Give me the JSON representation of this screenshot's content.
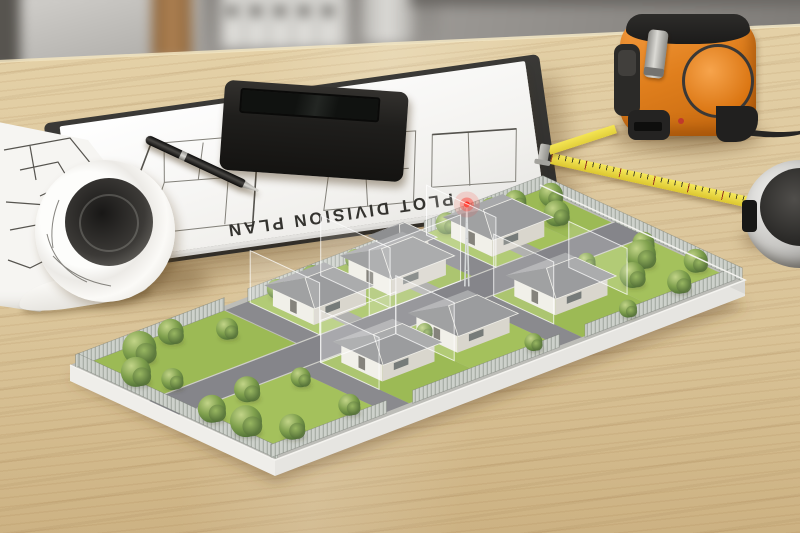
{
  "scene": {
    "type": "photograph",
    "setting": "Architect's desk with a miniature plot-division site model, clipboard, calculator, blueprints and measuring tools"
  },
  "clipboard": {
    "label": "clipboard with plan sheets",
    "title": "PLOT DIVISION PLAN",
    "title_orientation": "upside-down"
  },
  "objects": {
    "blueprint_roll": "rolled floor-plan blueprint",
    "pen": "black ballpoint pen",
    "calculator": "black desktop calculator with red key",
    "tape_measure": "orange and black tape measure with yellow tape and metal hook",
    "yellow_ruler": "yellow measuring strip with tick marks",
    "chrome_tape_measure": "chrome circular tape measure",
    "site_model": "plot division model: lawns, roads, houses, trees, fences, glass plot dividers, red beacon mast",
    "background": "blurred office shelf with binders, box, tube and cylinder"
  },
  "colors": {
    "wood": "#ddc89e",
    "paper": "#f2f1ee",
    "board": "#2e2d2b",
    "calc_body": "#1f1e1c",
    "key": "#31302d",
    "key_red": "#b5352c",
    "tape_orange": "#e07f1d",
    "tape_yellow": "#e2cf3a",
    "ruler_yellow": "#dcc62f",
    "chrome": "#c9c8c5",
    "grass": "#a4c15c",
    "grass_alt": "#9cba55",
    "road": "#85858a",
    "curb": "#cfcfc9",
    "base_top": "#bdbdb8",
    "base_side": "#eceae6",
    "house_wall": "#efede5",
    "house_wall_shade": "#d9d6cd",
    "roof_front": "#9b9c9e",
    "roof_side": "#8e8f91",
    "roof_back": "#a8a9ab",
    "fence": "#cdd1cb",
    "fence_slat": "#a9afa7",
    "tree_light": "#c2d488",
    "tree_mid": "#7fa04d",
    "tree_dark": "#4e6e35",
    "beacon_red": "#ff2b1e",
    "glass_edge": "#ffffff"
  }
}
